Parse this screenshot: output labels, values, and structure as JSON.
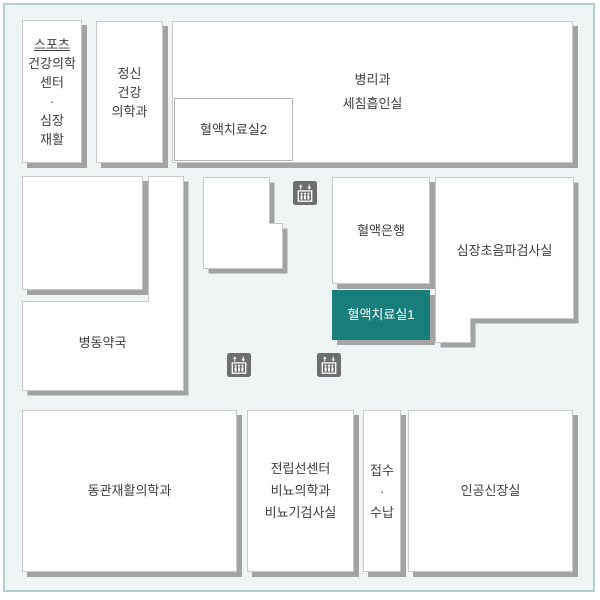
{
  "map": {
    "colors": {
      "background": "#eff5f5",
      "frame_border": "#b3cdd1",
      "room_fill": "#ffffff",
      "room_border": "#c9c9c9",
      "shadow": "#a3a3a3",
      "highlight": "#187e7c",
      "highlight_text": "#ffffff",
      "text": "#3e3e3e",
      "elevator_icon": "#6e6e6e"
    },
    "rooms": {
      "sports_center": {
        "lines": [
          "스포츠",
          "건강의학",
          "센터",
          "·",
          "심장",
          "재활"
        ]
      },
      "psychiatry": {
        "lines": [
          "정신",
          "건강",
          "의학과"
        ]
      },
      "pathology": {
        "lines": [
          "병리과",
          "세침흡인실"
        ]
      },
      "blood_therapy_2": {
        "label": "혈액치료실2"
      },
      "blood_bank": {
        "label": "혈액은행"
      },
      "cardiac_ultrasound": {
        "label": "심장초음파검사실"
      },
      "blood_therapy_1": {
        "label": "혈액치료실1",
        "highlighted": true
      },
      "ward_pharmacy": {
        "label": "병동약국"
      },
      "east_wing_rehab": {
        "label": "동관재활의학과"
      },
      "prostate_urology": {
        "lines": [
          "전립선센터",
          "비뇨의학과",
          "비뇨기검사실"
        ]
      },
      "reception_payment": {
        "lines": [
          "접수",
          "·",
          "수납"
        ]
      },
      "dialysis": {
        "label": "인공신장실"
      }
    },
    "icons": {
      "elevator": "elevator"
    }
  }
}
